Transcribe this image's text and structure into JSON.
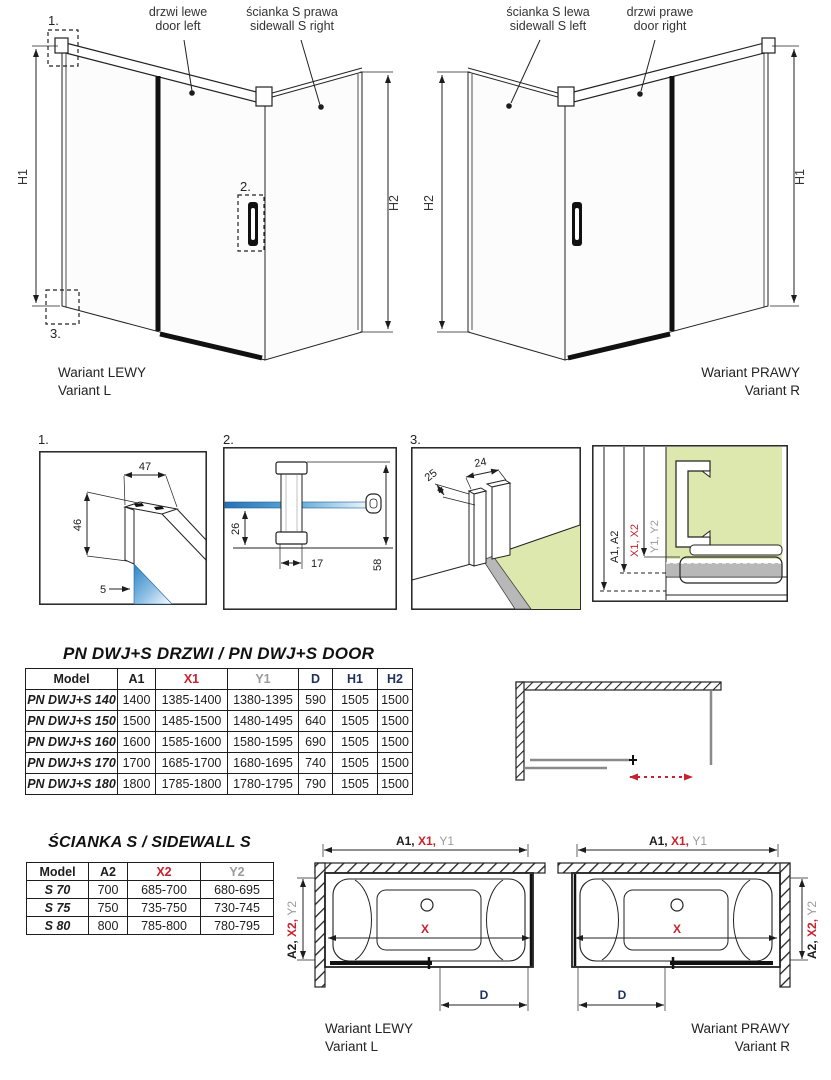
{
  "colors": {
    "accent_red": "#c8232c",
    "dim_gray": "#9b9b9b",
    "navy": "#20315f",
    "glass_blue": "#2e86c8",
    "wall_green": "#dde8ae",
    "glass_gray": "#b8b8b8"
  },
  "top_drawings": {
    "left": {
      "door_label_pl": "drzwi lewe",
      "door_label_en": "door left",
      "side_label_pl": "ścianka S prawa",
      "side_label_en": "sidewall S right",
      "dim_left": "H1",
      "dim_right": "H2",
      "callouts": {
        "c1": "1.",
        "c2": "2.",
        "c3": "3."
      },
      "caption_pl": "Wariant LEWY",
      "caption_en": "Variant L"
    },
    "right": {
      "side_label_pl": "ścianka S lewa",
      "side_label_en": "sidewall S left",
      "door_label_pl": "drzwi prawe",
      "door_label_en": "door right",
      "dim_left": "H2",
      "dim_right": "H1",
      "caption_pl": "Wariant PRAWY",
      "caption_en": "Variant R"
    }
  },
  "details": {
    "d1": {
      "label": "1.",
      "dim_width": "47",
      "dim_height": "46",
      "dim_glass": "5"
    },
    "d2": {
      "label": "2.",
      "dim_offset": "26",
      "dim_width": "17",
      "dim_height": "58"
    },
    "d3": {
      "label": "3.",
      "dim_depth": "25",
      "dim_width": "24"
    },
    "d4": {
      "dim_a": "A1, A2",
      "dim_x": "X1, X2",
      "dim_y": "Y1, Y2"
    }
  },
  "door_table": {
    "title": "PN DWJ+S DRZWI / PN DWJ+S DOOR",
    "headers": [
      "Model",
      "A1",
      "X1",
      "Y1",
      "D",
      "H1",
      "H2"
    ],
    "rows": [
      [
        "PN DWJ+S 140",
        "1400",
        "1385-1400",
        "1380-1395",
        "590",
        "1505",
        "1500"
      ],
      [
        "PN DWJ+S 150",
        "1500",
        "1485-1500",
        "1480-1495",
        "640",
        "1505",
        "1500"
      ],
      [
        "PN DWJ+S 160",
        "1600",
        "1585-1600",
        "1580-1595",
        "690",
        "1505",
        "1500"
      ],
      [
        "PN DWJ+S 170",
        "1700",
        "1685-1700",
        "1680-1695",
        "740",
        "1505",
        "1500"
      ],
      [
        "PN DWJ+S 180",
        "1800",
        "1785-1800",
        "1780-1795",
        "790",
        "1505",
        "1500"
      ]
    ]
  },
  "sidewall_table": {
    "title": "ŚCIANKA S / SIDEWALL S",
    "headers": [
      "Model",
      "A2",
      "X2",
      "Y2"
    ],
    "rows": [
      [
        "S 70",
        "700",
        "685-700",
        "680-695"
      ],
      [
        "S 75",
        "750",
        "735-750",
        "730-745"
      ],
      [
        "S 80",
        "800",
        "785-800",
        "780-795"
      ]
    ]
  },
  "plan_views": {
    "left": {
      "dim_top_a": "A1, ",
      "dim_top_x": "X1, ",
      "dim_top_y": "Y1",
      "dim_side_a": "A2, ",
      "dim_side_x": "X2, ",
      "dim_side_y": "Y2",
      "dim_x": "X",
      "dim_d": "D",
      "caption_pl": "Wariant LEWY",
      "caption_en": "Variant L"
    },
    "right": {
      "dim_top_a": "A1, ",
      "dim_top_x": "X1, ",
      "dim_top_y": "Y1",
      "dim_side_a": "A2, ",
      "dim_side_x": "X2, ",
      "dim_side_y": "Y2",
      "dim_x": "X",
      "dim_d": "D",
      "caption_pl": "Wariant PRAWY",
      "caption_en": "Variant R"
    }
  }
}
